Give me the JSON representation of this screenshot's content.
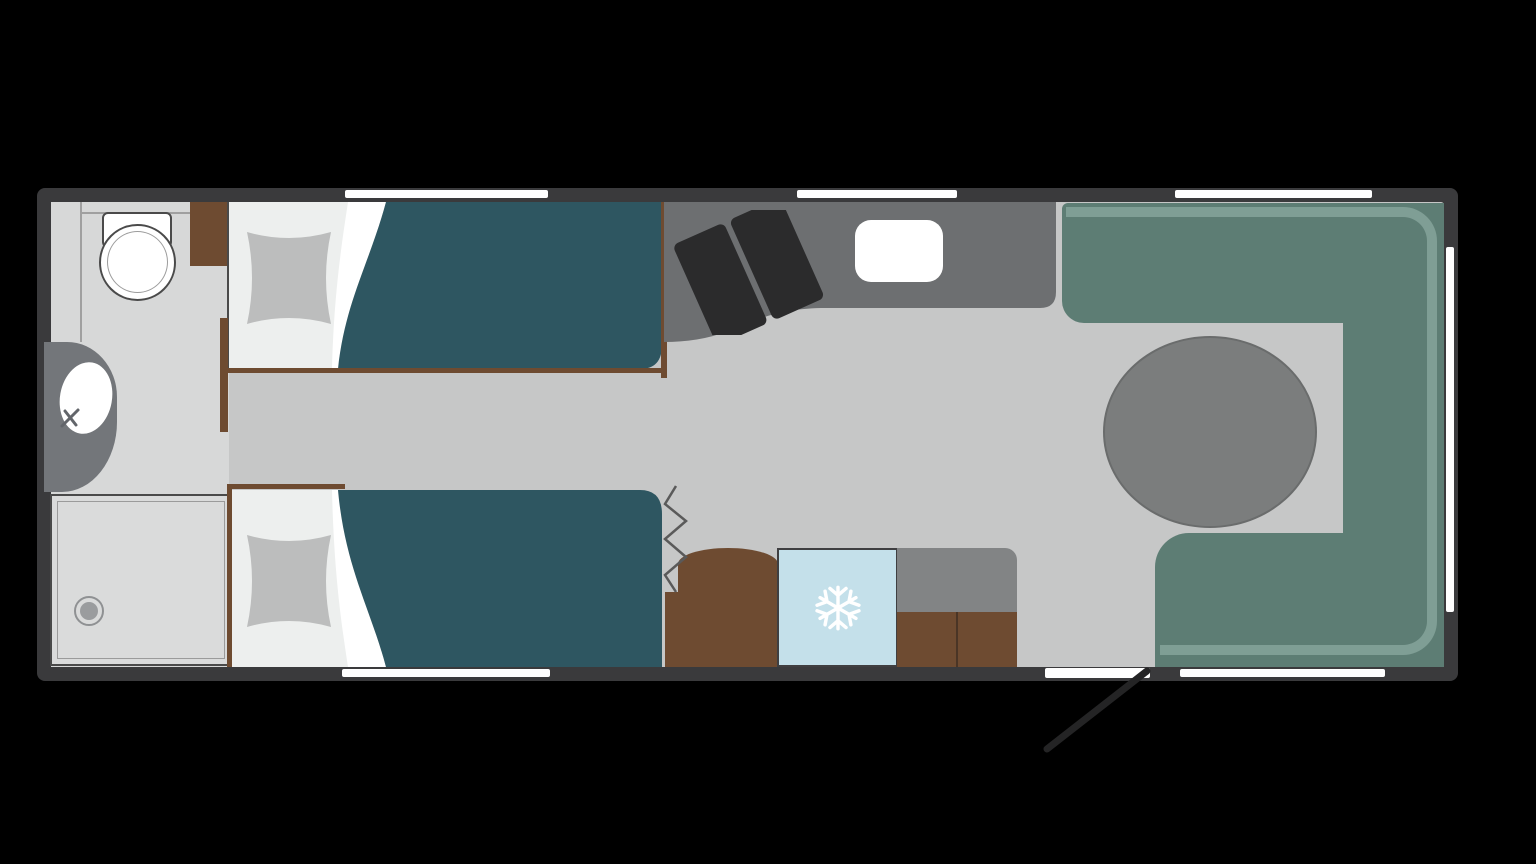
{
  "title": "caravan-floorplan",
  "colors": {
    "bg": "#000000",
    "wall": "#3a3a3c",
    "window": "#ffffff",
    "floor": "#c6c7c7",
    "floor_bath": "#d7d8d8",
    "shower": "#dadbdb",
    "outline": "#4a4a4a",
    "line": "#a0a0a0",
    "fixture": "#73767a",
    "bedding": "#edefee",
    "fold": "#ffffff",
    "pillow": "#bcbdbd",
    "duvet": "#2e5661",
    "wood": "#6e4b31",
    "counter": "#6d6f71",
    "stove": "#2b2b2c",
    "bench": "#5d7d74",
    "backrest": "#7f9e95",
    "table": "#7b7d7d",
    "table_border": "#6a6c6c",
    "fridge": "#c4e0ea",
    "cab_gray": "#828485",
    "door": "#242425"
  },
  "features": {
    "rooms": [
      "bathroom",
      "twin-bedroom",
      "kitchen",
      "lounge-dinette"
    ],
    "fixtures": [
      "toilet",
      "washbasin",
      "faucet",
      "shower-tray",
      "drain",
      "single-bed-top",
      "single-bed-bottom",
      "pillow",
      "duvet",
      "wardrobe",
      "hob",
      "kitchen-sink",
      "fridge-freezer",
      "cabinet",
      "round-table",
      "u-shaped-bench",
      "entry-door",
      "curtain-divider"
    ],
    "icons": [
      "snowflake-icon"
    ],
    "counts": {
      "windows": 6,
      "doors": 1,
      "beds": 2,
      "hob_plates": 2
    },
    "bench_shape": "u-shaped",
    "table_shape": "round"
  }
}
